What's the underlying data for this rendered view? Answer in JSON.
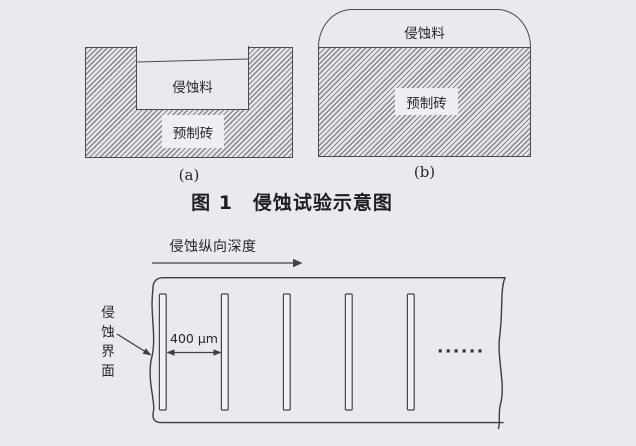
{
  "colors": {
    "paper_background": "#e9e9ee",
    "ink": "#3f3f46",
    "hatch_line": "#86868e"
  },
  "figure1": {
    "caption": "图 1　侵蚀试验示意图",
    "panel_a": {
      "label": "(a)",
      "corrosive_material_label": "侵蚀料",
      "brick_label": "预制砖"
    },
    "panel_b": {
      "label": "(b)",
      "corrosive_material_label": "侵蚀料",
      "brick_label": "预制砖"
    }
  },
  "figure2": {
    "direction_label": "侵蚀纵向深度",
    "spacing_label": "400 μm",
    "interface_label": "侵蚀界面",
    "continuation_dots": "······"
  }
}
